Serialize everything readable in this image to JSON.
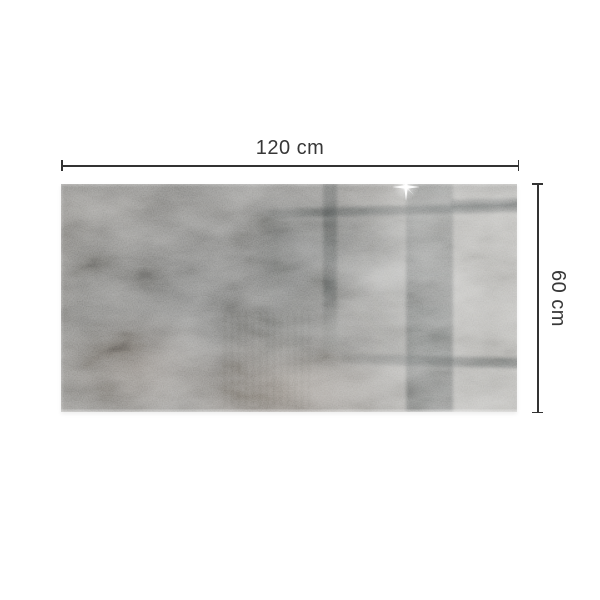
{
  "page": {
    "background_color": "#ffffff",
    "description": "Product dimension photo of a glossy concrete-look rectangular tile panel"
  },
  "dimensions": {
    "width_label": "120 cm",
    "height_label": "60 cm",
    "line_color": "#333333",
    "label_color": "#373737"
  },
  "product_photo": {
    "name": "glossy concrete-effect tile panel",
    "aspect_ratio": "2:1",
    "palette": {
      "base_gray": "#86847f",
      "dark_gray": "#6f6f6d",
      "light_gray": "#a7a6a2",
      "rust_tint": "#8a7468",
      "reflection_bar": "#3c4141",
      "highlight": "#ffffff"
    },
    "features": [
      "window-frame reflection bars",
      "wide vertical reflection band",
      "lens-flare sparkle highlight at top edge",
      "mottled concrete texture with rust patches",
      "glossy sheen on right half"
    ]
  },
  "icons": {
    "sparkle": "lens-flare-star"
  }
}
